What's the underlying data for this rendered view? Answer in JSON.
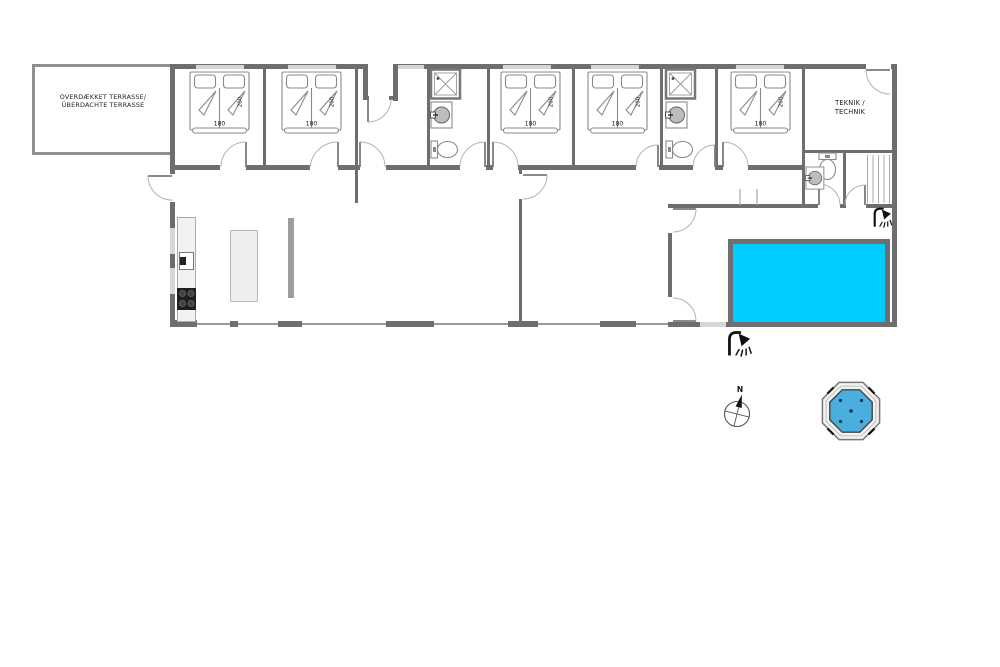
{
  "floor_plan": {
    "terrace": {
      "line1": "OVERDÆKKET TERRASSE/",
      "line2": "ÜBERDACHTE TERRASSE"
    },
    "technical_room": {
      "line1": "TEKNIK /",
      "line2": "TECHNIK"
    },
    "compass": {
      "north": "N"
    },
    "bedrooms": [
      {
        "bed_width": "180",
        "bed_length": "200"
      },
      {
        "bed_width": "180",
        "bed_length": "200"
      },
      {
        "bed_width": "180",
        "bed_length": "200"
      },
      {
        "bed_width": "180",
        "bed_length": "200"
      },
      {
        "bed_width": "180",
        "bed_length": "200"
      }
    ],
    "colors": {
      "pool_water": "#00ccff",
      "hot_tub_water": "#4aaede",
      "wall": "#6e6e6e"
    },
    "icons": [
      "shower-icon",
      "compass-icon",
      "hot-tub-icon",
      "toilet-icon",
      "sink-icon",
      "shower-cabin-icon",
      "stove-icon",
      "kitchen-sink-icon"
    ]
  }
}
